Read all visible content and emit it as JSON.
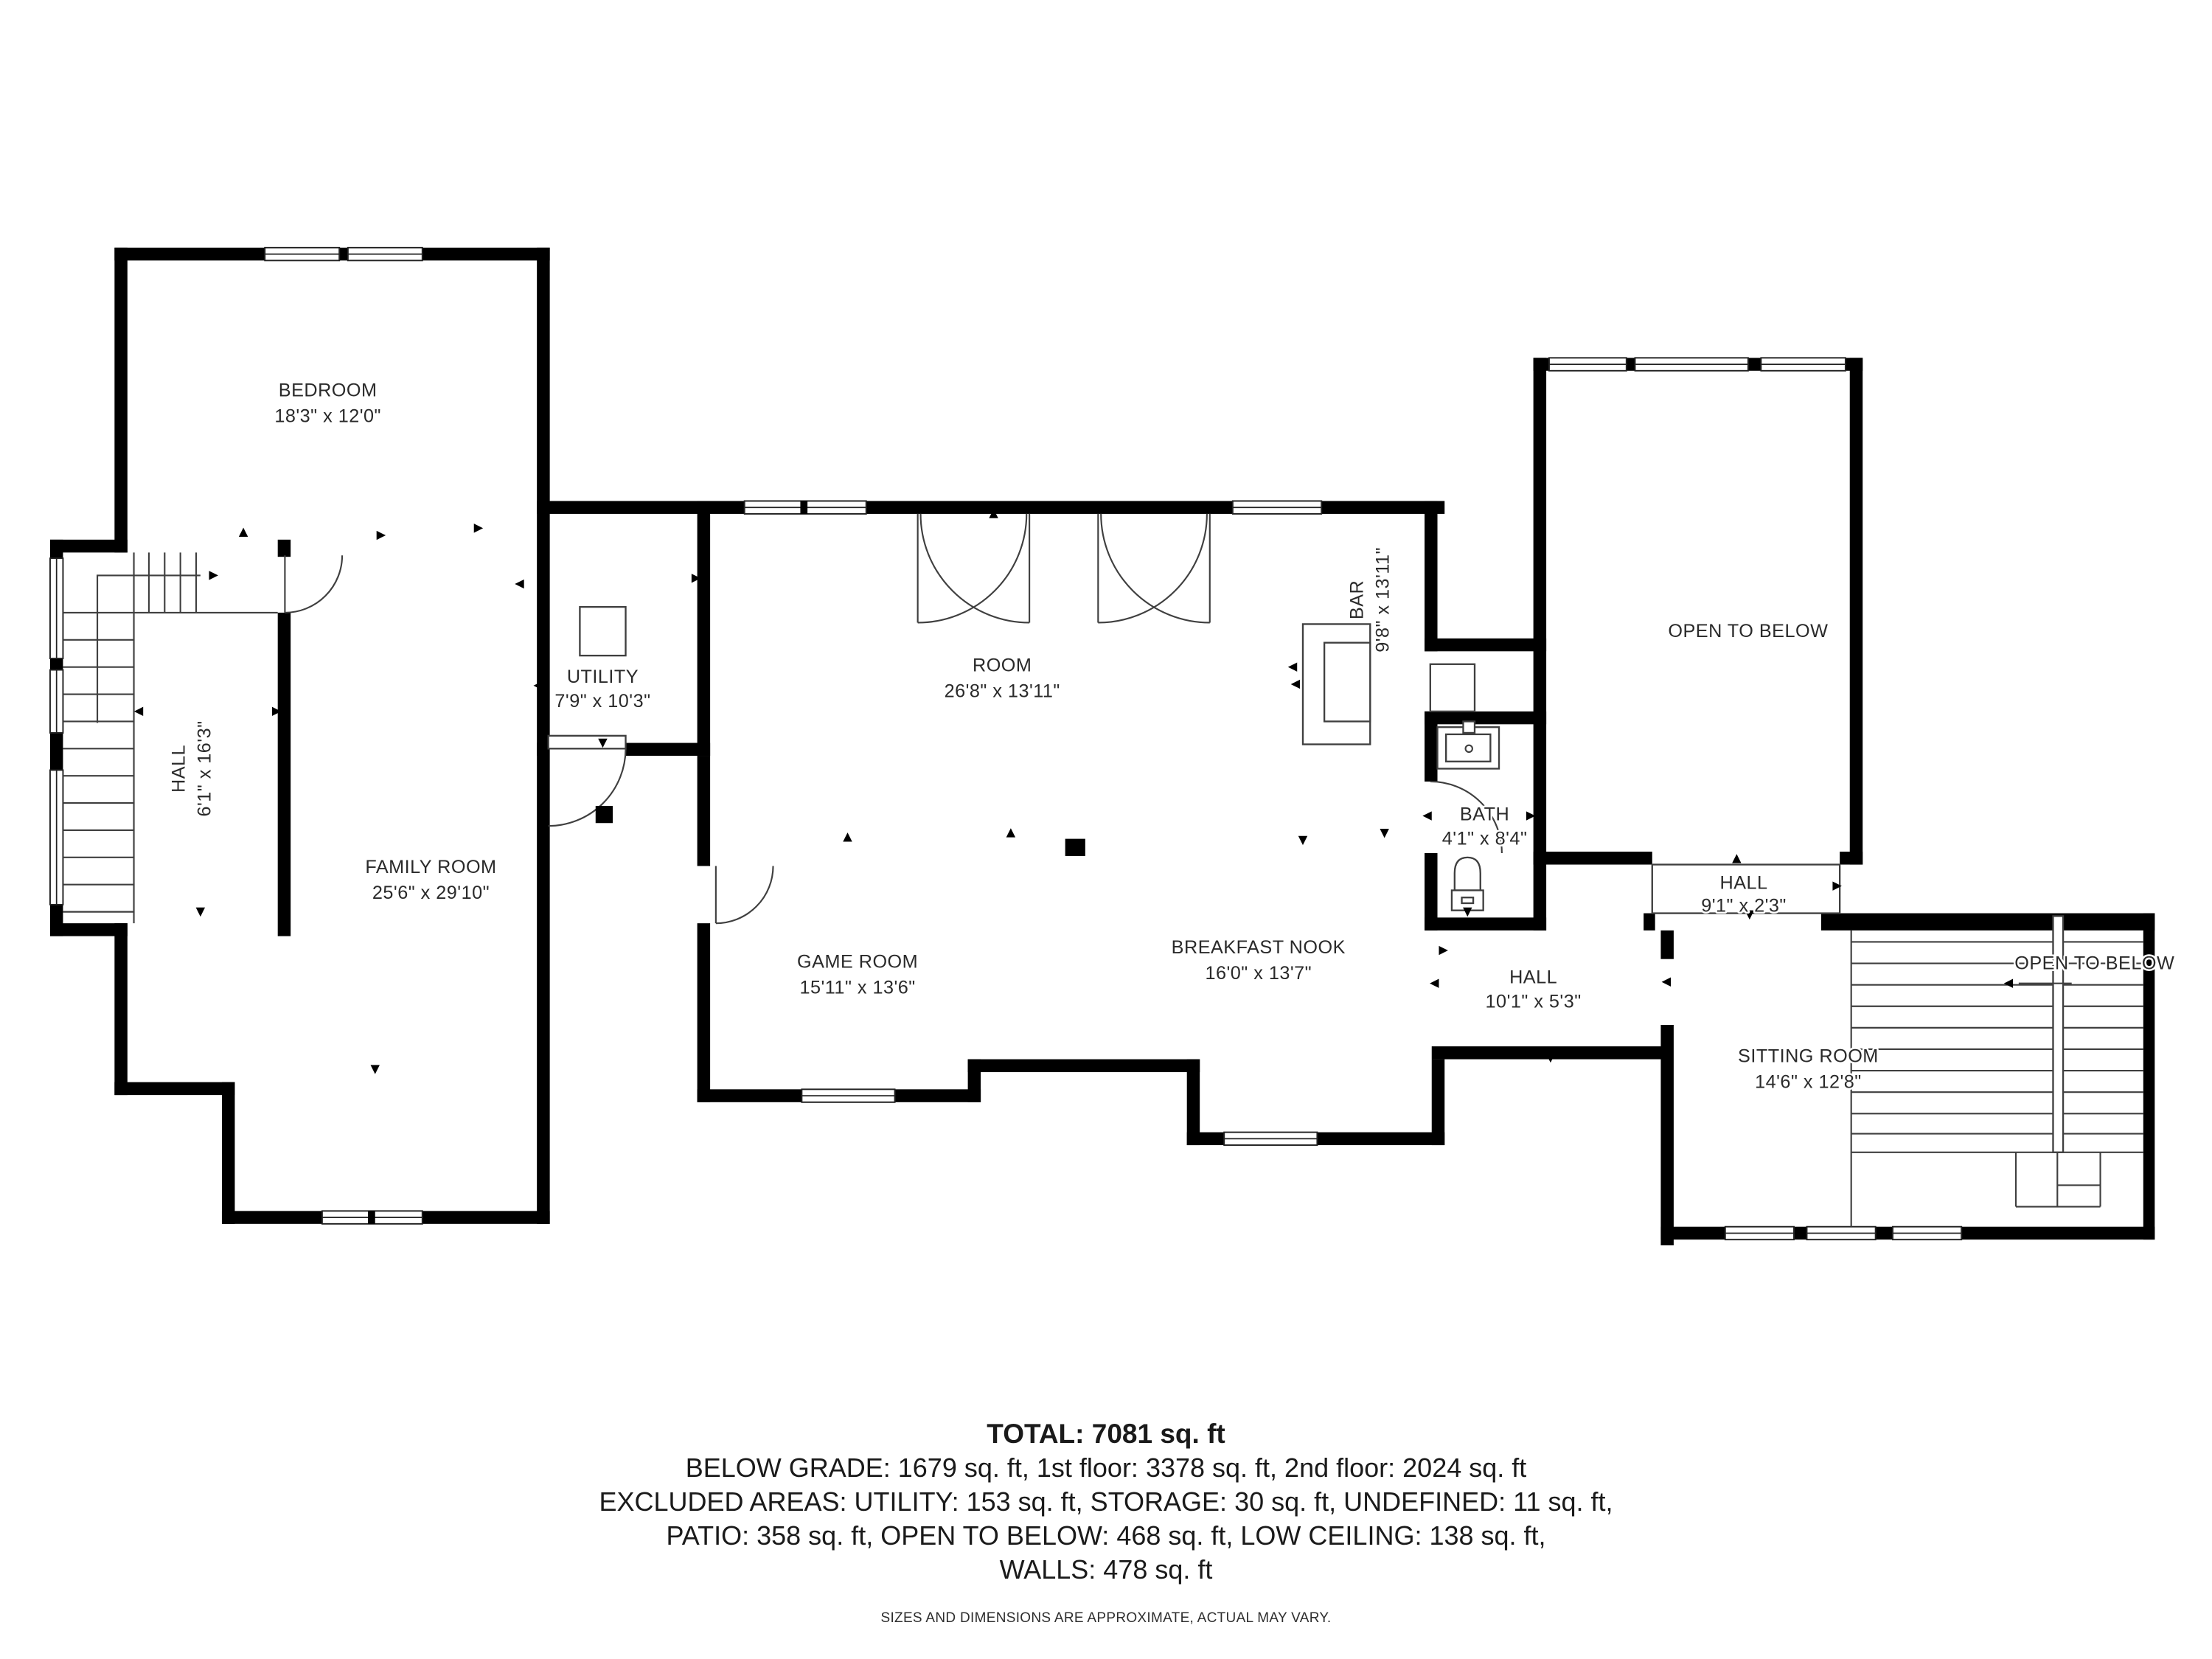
{
  "rooms": [
    {
      "id": "bedroom",
      "name": "BEDROOM",
      "dims": "18'3\" x 12'0\""
    },
    {
      "id": "hall-upper",
      "name": "HALL",
      "dims": "6'1\" x 16'3\""
    },
    {
      "id": "utility",
      "name": "UTILITY",
      "dims": "7'9\" x 10'3\""
    },
    {
      "id": "room",
      "name": "ROOM",
      "dims": "26'8\" x 13'11\""
    },
    {
      "id": "bar",
      "name": "BAR",
      "dims": "9'8\" x 13'11\""
    },
    {
      "id": "open-to-below-main",
      "name": "OPEN TO BELOW"
    },
    {
      "id": "family-room",
      "name": "FAMILY ROOM",
      "dims": "25'6\" x 29'10\""
    },
    {
      "id": "game-room",
      "name": "GAME ROOM",
      "dims": "15'11\" x 13'6\""
    },
    {
      "id": "breakfast-nook",
      "name": "BREAKFAST NOOK",
      "dims": "16'0\" x 13'7\""
    },
    {
      "id": "bath",
      "name": "BATH",
      "dims": "4'1\" x 8'4\""
    },
    {
      "id": "hall-strip",
      "name": "HALL",
      "dims": "9'1\" x 2'3\""
    },
    {
      "id": "hall-lower",
      "name": "HALL",
      "dims": "10'1\" x 5'3\""
    },
    {
      "id": "sitting-room",
      "name": "SITTING ROOM",
      "dims": "14'6\" x 12'8\""
    },
    {
      "id": "open-to-below-stairs",
      "name": "OPEN TO BELOW"
    }
  ],
  "summary": {
    "total": "TOTAL: 7081 sq. ft",
    "line1": "BELOW GRADE: 1679 sq. ft, 1st floor: 3378 sq. ft, 2nd floor: 2024 sq. ft",
    "line2": "EXCLUDED AREAS: UTILITY: 153 sq. ft, STORAGE: 30 sq. ft, UNDEFINED: 11 sq. ft,",
    "line3": "PATIO: 358 sq. ft, OPEN TO BELOW: 468 sq. ft, LOW CEILING: 138 sq. ft,",
    "line4": "WALLS: 478 sq. ft",
    "disclaimer": "SIZES AND DIMENSIONS ARE APPROXIMATE, ACTUAL MAY VARY."
  },
  "colors": {
    "wall": "#000000",
    "line": "#3f3f3f",
    "text": "#2a2a2a",
    "background": "#ffffff"
  }
}
